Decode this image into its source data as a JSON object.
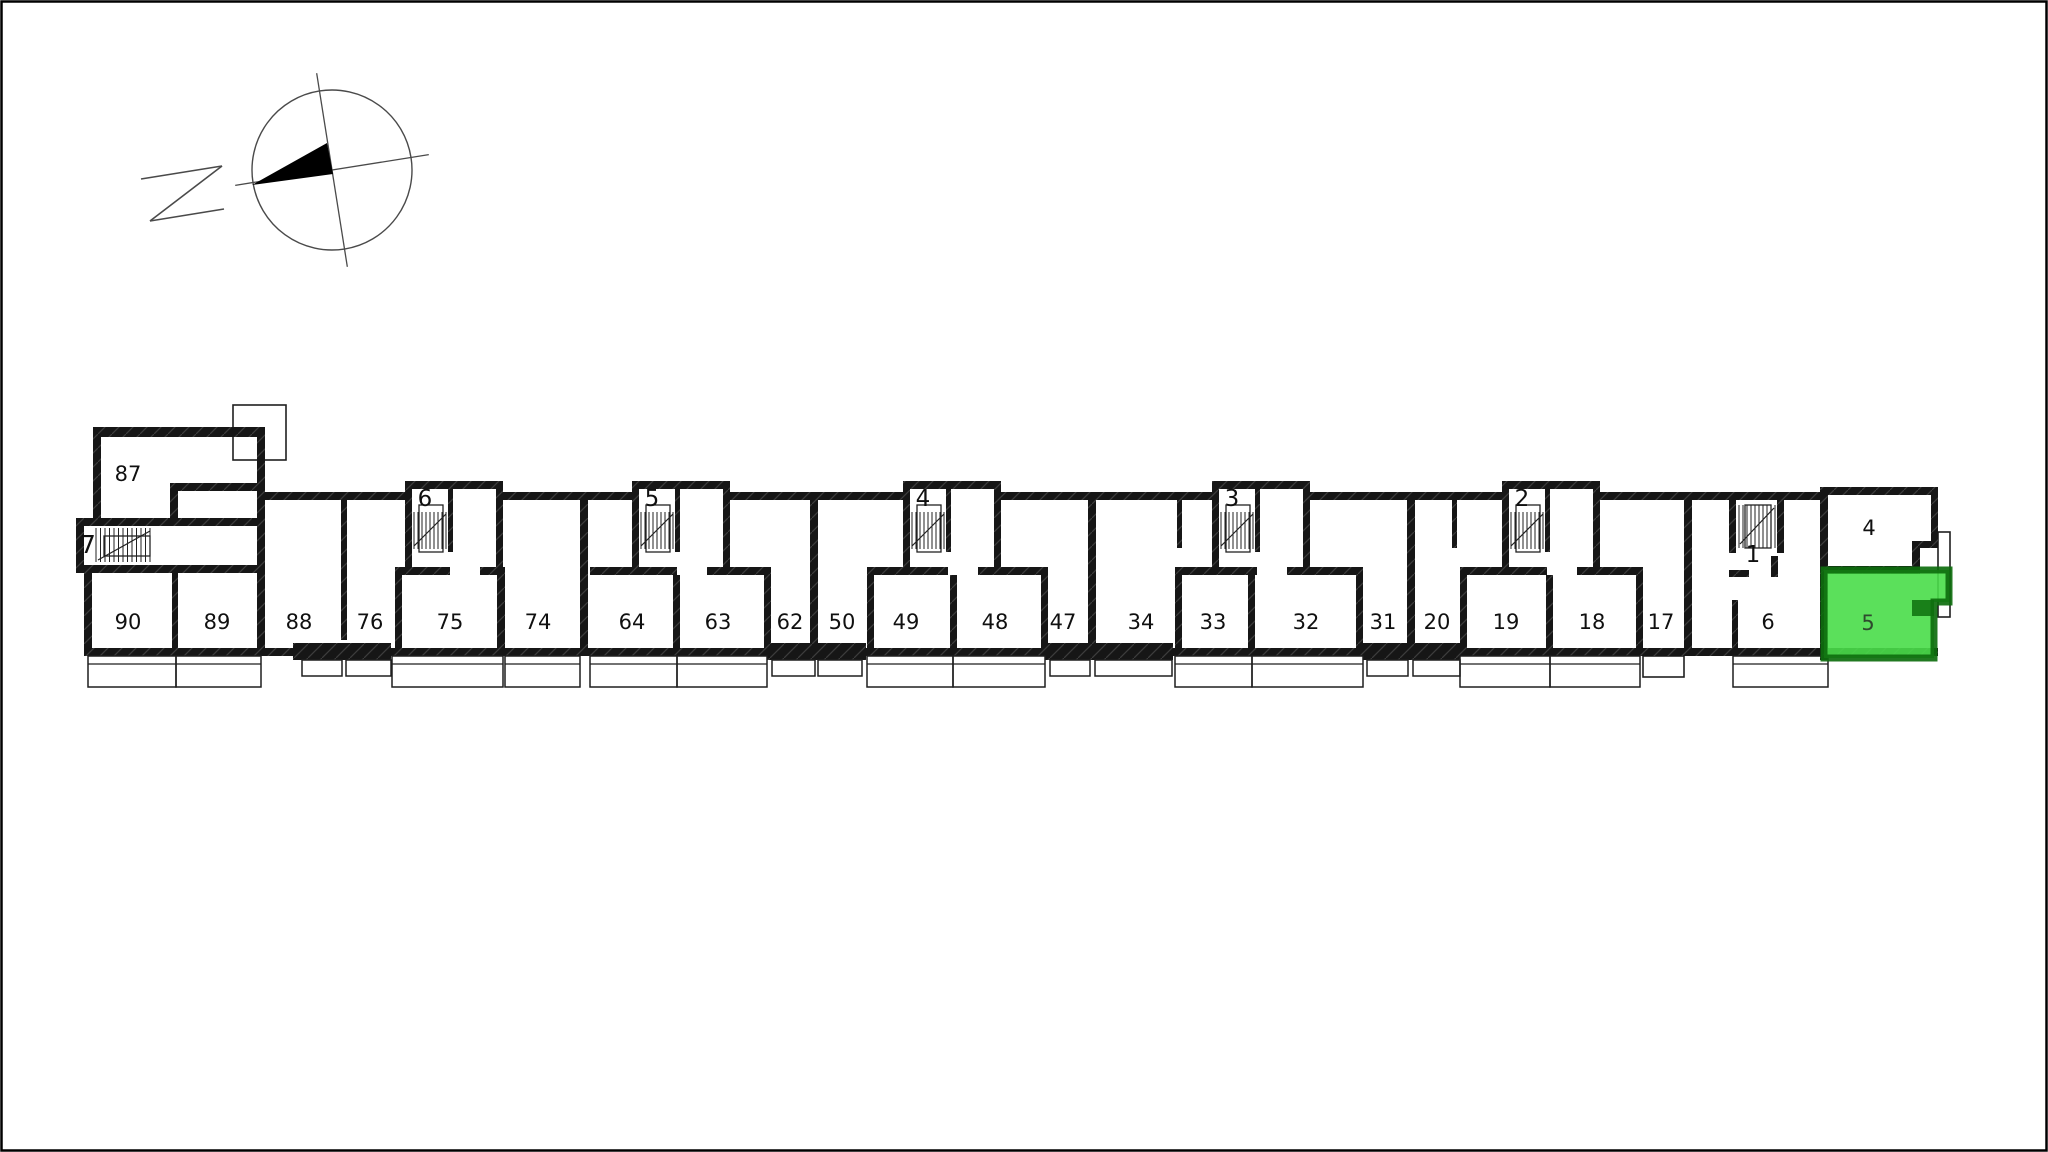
{
  "canvas": {
    "width": 2048,
    "height": 1152,
    "background": "#ffffff",
    "border_color": "#000000"
  },
  "compass": {
    "letter": "N",
    "cx": 332,
    "cy": 170,
    "radius": 80,
    "rotation_deg": -9,
    "needle_points": "252,185 327,143 333,174",
    "letter_lines": [
      [
        141,
        179,
        222,
        166
      ],
      [
        222,
        166,
        150,
        221
      ],
      [
        150,
        221,
        224,
        209
      ]
    ],
    "line_color": "#4a4a4a",
    "needle_color": "#000000"
  },
  "plan": {
    "colors": {
      "wall": "#161616",
      "wall_hatch": "#3d3d3d",
      "thin": "#1f1f1f",
      "label": "#101010",
      "highlight_fill": "#49DD49",
      "highlight_wall": "#0E6E0E",
      "highlight_label": "#2e4a2e"
    },
    "room_labels": [
      {
        "label": "87",
        "x": 128,
        "y": 481
      },
      {
        "label": "90",
        "x": 128,
        "y": 629
      },
      {
        "label": "89",
        "x": 217,
        "y": 629
      },
      {
        "label": "88",
        "x": 299,
        "y": 629
      },
      {
        "label": "76",
        "x": 370,
        "y": 629
      },
      {
        "label": "75",
        "x": 450,
        "y": 629
      },
      {
        "label": "74",
        "x": 538,
        "y": 629
      },
      {
        "label": "64",
        "x": 632,
        "y": 629
      },
      {
        "label": "63",
        "x": 718,
        "y": 629
      },
      {
        "label": "62",
        "x": 790,
        "y": 629
      },
      {
        "label": "50",
        "x": 842,
        "y": 629
      },
      {
        "label": "49",
        "x": 906,
        "y": 629
      },
      {
        "label": "48",
        "x": 995,
        "y": 629
      },
      {
        "label": "47",
        "x": 1063,
        "y": 629
      },
      {
        "label": "34",
        "x": 1141,
        "y": 629
      },
      {
        "label": "33",
        "x": 1213,
        "y": 629
      },
      {
        "label": "32",
        "x": 1306,
        "y": 629
      },
      {
        "label": "31",
        "x": 1383,
        "y": 629
      },
      {
        "label": "20",
        "x": 1437,
        "y": 629
      },
      {
        "label": "19",
        "x": 1506,
        "y": 629
      },
      {
        "label": "18",
        "x": 1592,
        "y": 629
      },
      {
        "label": "17",
        "x": 1661,
        "y": 629
      },
      {
        "label": "6",
        "x": 1768,
        "y": 629
      },
      {
        "label": "4",
        "x": 1869,
        "y": 535
      }
    ],
    "stair_modules": [
      {
        "label": "6",
        "x": 405,
        "rooms_span": [
          395,
          503
        ]
      },
      {
        "label": "5",
        "x": 632,
        "rooms_span": [
          590,
          771
        ]
      },
      {
        "label": "4",
        "x": 903,
        "rooms_span": [
          867,
          1048
        ]
      },
      {
        "label": "3",
        "x": 1212,
        "rooms_span": [
          1175,
          1363
        ]
      },
      {
        "label": "2",
        "x": 1502,
        "rooms_span": [
          1460,
          1643
        ]
      }
    ],
    "stairwell_1": {
      "label": "1",
      "x": 1739,
      "y": 505,
      "label_x": 1753,
      "label_y": 562
    },
    "stairwell_7": {
      "label": "7",
      "label_x": 88,
      "label_y": 553,
      "stairs_x": 96,
      "stairs_y": 528
    },
    "walls": [
      [
        93,
        427,
        172,
        10
      ],
      [
        93,
        427,
        8,
        95
      ],
      [
        257,
        427,
        8,
        229
      ],
      [
        170,
        483,
        92,
        8
      ],
      [
        170,
        483,
        8,
        43
      ],
      [
        76,
        518,
        186,
        8
      ],
      [
        76,
        518,
        8,
        55
      ],
      [
        76,
        565,
        186,
        8
      ],
      [
        84,
        565,
        8,
        91
      ],
      [
        172,
        571,
        6,
        80
      ],
      [
        84,
        648,
        181,
        8
      ],
      [
        265,
        492,
        140,
        8
      ],
      [
        503,
        492,
        129,
        8
      ],
      [
        730,
        492,
        173,
        8
      ],
      [
        1000,
        492,
        212,
        8
      ],
      [
        1310,
        492,
        192,
        8
      ],
      [
        1600,
        492,
        222,
        8
      ],
      [
        580,
        492,
        8,
        164
      ],
      [
        810,
        492,
        8,
        164
      ],
      [
        1088,
        492,
        8,
        164
      ],
      [
        1407,
        492,
        8,
        164
      ],
      [
        1684,
        492,
        8,
        164
      ],
      [
        341,
        500,
        6,
        140
      ],
      [
        1177,
        500,
        5,
        48
      ],
      [
        1452,
        500,
        5,
        48
      ],
      [
        395,
        567,
        7,
        89
      ],
      [
        497,
        567,
        8,
        89
      ],
      [
        673,
        575,
        7,
        81
      ],
      [
        764,
        567,
        7,
        89
      ],
      [
        867,
        567,
        7,
        89
      ],
      [
        950,
        575,
        7,
        81
      ],
      [
        1041,
        567,
        7,
        89
      ],
      [
        1175,
        567,
        7,
        89
      ],
      [
        1248,
        575,
        7,
        81
      ],
      [
        1356,
        567,
        7,
        89
      ],
      [
        1460,
        567,
        7,
        89
      ],
      [
        1546,
        575,
        7,
        81
      ],
      [
        1636,
        567,
        7,
        89
      ],
      [
        1729,
        492,
        7,
        61
      ],
      [
        1777,
        492,
        7,
        61
      ],
      [
        1729,
        570,
        20,
        7
      ],
      [
        1771,
        556,
        7,
        21
      ],
      [
        1732,
        600,
        6,
        56
      ],
      [
        1822,
        487,
        116,
        8
      ],
      [
        1820,
        487,
        8,
        173
      ],
      [
        1931,
        487,
        7,
        57
      ],
      [
        1912,
        541,
        26,
        7
      ],
      [
        1912,
        548,
        8,
        26
      ],
      [
        1822,
        566,
        97,
        8
      ],
      [
        265,
        648,
        1673,
        8
      ],
      [
        293,
        643,
        98,
        17
      ],
      [
        767,
        643,
        99,
        17
      ],
      [
        1045,
        643,
        128,
        17
      ],
      [
        1363,
        643,
        97,
        17
      ]
    ],
    "thin_rects": [
      [
        233,
        405,
        53,
        55
      ],
      [
        1938,
        532,
        12,
        85
      ],
      [
        1643,
        656,
        41,
        21
      ]
    ],
    "balconies_deep": [
      [
        88,
        176
      ],
      [
        176,
        261
      ],
      [
        392,
        503
      ],
      [
        505,
        580
      ],
      [
        590,
        677
      ],
      [
        677,
        767
      ],
      [
        867,
        953
      ],
      [
        953,
        1045
      ],
      [
        1175,
        1252
      ],
      [
        1252,
        1363
      ],
      [
        1460,
        1550
      ],
      [
        1550,
        1640
      ],
      [
        1733,
        1828
      ]
    ],
    "balconies_shallow": [
      [
        302,
        342
      ],
      [
        346,
        391
      ],
      [
        772,
        815
      ],
      [
        818,
        862
      ],
      [
        1050,
        1090
      ],
      [
        1095,
        1172
      ],
      [
        1367,
        1408
      ],
      [
        1413,
        1460
      ]
    ],
    "highlight": {
      "polygon": "1824,570 1949,570 1949,602 1934,602 1934,658 1824,658",
      "step_rect": [
        1912,
        600,
        22,
        16
      ],
      "label": "5",
      "label_x": 1868,
      "label_y": 630
    }
  }
}
